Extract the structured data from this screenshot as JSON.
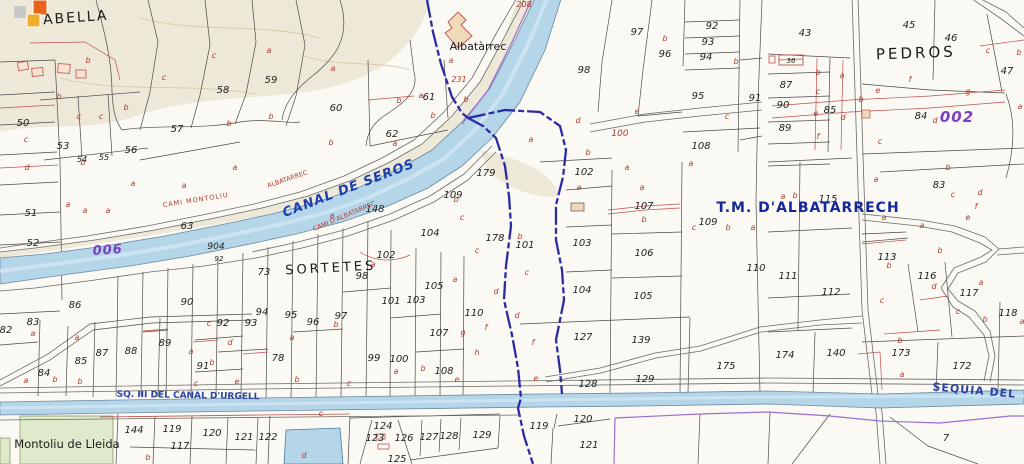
{
  "map": {
    "description": "Cadastral / topographic sheet around Albatarrec, Montoliu de Lleida",
    "colors": {
      "water": "#b5d6e8",
      "water_edge": "#6889a0",
      "municipal_boundary": "#2b2ba6",
      "purple_line": "#9a6fd0",
      "canal_label_blue": "#1b3fae",
      "tm_label_blue": "#16269b",
      "urgell_label_blue": "#2a43a5",
      "cadastral_red": "#b03a2e",
      "purple_code": "#7d3fc1",
      "terrain_tan": "#ebe4d2",
      "green_area": "#dfe9cc"
    },
    "legend_swatches": [
      {
        "name": "grey-swatch",
        "color": "#c8c8c8"
      },
      {
        "name": "orange-swatch",
        "color": "#e8641c"
      },
      {
        "name": "amber-swatch",
        "color": "#efac2d"
      }
    ],
    "place_labels": [
      {
        "text": "ABELLA",
        "x": 76,
        "y": 22,
        "size": 14,
        "color": "#1a1a1a",
        "rot": -4,
        "ls": 2
      },
      {
        "text": "Albatàrrec",
        "x": 478,
        "y": 50,
        "size": 11,
        "color": "#1a1a1a",
        "rot": 0,
        "ls": 0
      },
      {
        "text": "CANAL DE SEROS",
        "x": 350,
        "y": 192,
        "size": 13,
        "color": "#1b3fae",
        "rot": -21,
        "bold": true,
        "italic": true,
        "ls": 1
      },
      {
        "text": "CAMI D'ALBATARREC",
        "x": 345,
        "y": 218,
        "size": 6.5,
        "color": "#b03a2e",
        "rot": -23,
        "ls": 0
      },
      {
        "text": "ALBATARREC",
        "x": 288,
        "y": 181,
        "size": 6.5,
        "color": "#b03a2e",
        "rot": -19,
        "ls": 0
      },
      {
        "text": "CAMI   MONTOLIU",
        "x": 196,
        "y": 202,
        "size": 6.5,
        "color": "#b03a2e",
        "rot": -9,
        "ls": 1
      },
      {
        "text": "SORTETES",
        "x": 331,
        "y": 272,
        "size": 13,
        "color": "#1a1a1a",
        "rot": -3,
        "ls": 3
      },
      {
        "text": "T.M. D'ALBATARRECH",
        "x": 808,
        "y": 212,
        "size": 14,
        "color": "#16269b",
        "rot": 0,
        "bold": true,
        "ls": 1
      },
      {
        "text": "PEDROS",
        "x": 916,
        "y": 58,
        "size": 15,
        "color": "#1a1a1a",
        "rot": -2,
        "ls": 3
      },
      {
        "text": "002",
        "x": 957,
        "y": 122,
        "size": 15,
        "color": "#7d3fc1",
        "rot": 0,
        "bold": true,
        "italic": true,
        "ls": 1
      },
      {
        "text": "006",
        "x": 108,
        "y": 254,
        "size": 13,
        "color": "#7d3fc1",
        "rot": -4,
        "bold": true,
        "italic": true,
        "ls": 1
      },
      {
        "text": "SQ. III DEL CANAL D'URGELL",
        "x": 188,
        "y": 398,
        "size": 9,
        "color": "#2a43a5",
        "rot": 1,
        "bold": true,
        "ls": 0
      },
      {
        "text": "SEQUIA DEL",
        "x": 974,
        "y": 394,
        "size": 11,
        "color": "#2a43a5",
        "rot": 5,
        "bold": true,
        "ls": 1
      },
      {
        "text": "Montoliu de Lleida",
        "x": 67,
        "y": 448,
        "size": 11.5,
        "color": "#1a1a1a",
        "rot": 0,
        "ls": 0
      }
    ],
    "parcel_numbers": [
      {
        "t": "50",
        "x": 23,
        "y": 126
      },
      {
        "t": "53",
        "x": 63,
        "y": 149
      },
      {
        "t": "56",
        "x": 131,
        "y": 153
      },
      {
        "t": "57",
        "x": 177,
        "y": 132
      },
      {
        "t": "58",
        "x": 223,
        "y": 93
      },
      {
        "t": "59",
        "x": 271,
        "y": 83
      },
      {
        "t": "60",
        "x": 336,
        "y": 111
      },
      {
        "t": "61",
        "x": 429,
        "y": 100
      },
      {
        "t": "62",
        "x": 392,
        "y": 137
      },
      {
        "t": "231",
        "x": 459,
        "y": 82,
        "c": "#b03a2e",
        "s": 8
      },
      {
        "t": "208",
        "x": 524,
        "y": 7,
        "c": "#b03a2e",
        "s": 8
      },
      {
        "t": "97",
        "x": 637,
        "y": 35
      },
      {
        "t": "96",
        "x": 665,
        "y": 57
      },
      {
        "t": "98",
        "x": 584,
        "y": 73
      },
      {
        "t": "92",
        "x": 712,
        "y": 29
      },
      {
        "t": "93",
        "x": 708,
        "y": 45
      },
      {
        "t": "94",
        "x": 706,
        "y": 60
      },
      {
        "t": "95",
        "x": 698,
        "y": 99
      },
      {
        "t": "91",
        "x": 755,
        "y": 101
      },
      {
        "t": "100",
        "x": 620,
        "y": 136,
        "c": "#b03a2e",
        "s": 9
      },
      {
        "t": "108",
        "x": 701,
        "y": 149
      },
      {
        "t": "43",
        "x": 805,
        "y": 36
      },
      {
        "t": "45",
        "x": 909,
        "y": 28
      },
      {
        "t": "46",
        "x": 951,
        "y": 41
      },
      {
        "t": "47",
        "x": 1007,
        "y": 74
      },
      {
        "t": "87",
        "x": 786,
        "y": 88
      },
      {
        "t": "90",
        "x": 783,
        "y": 108
      },
      {
        "t": "85",
        "x": 830,
        "y": 113
      },
      {
        "t": "89",
        "x": 785,
        "y": 131
      },
      {
        "t": "84",
        "x": 921,
        "y": 119
      },
      {
        "t": "36",
        "x": 791,
        "y": 63,
        "s": 7
      },
      {
        "t": "51",
        "x": 31,
        "y": 216
      },
      {
        "t": "52",
        "x": 33,
        "y": 246
      },
      {
        "t": "54",
        "x": 82,
        "y": 162,
        "s": 8
      },
      {
        "t": "55",
        "x": 104,
        "y": 160,
        "s": 8
      },
      {
        "t": "63",
        "x": 187,
        "y": 229
      },
      {
        "t": "904",
        "x": 216,
        "y": 249,
        "s": 9
      },
      {
        "t": "92",
        "x": 219,
        "y": 261,
        "s": 7
      },
      {
        "t": "86",
        "x": 75,
        "y": 308
      },
      {
        "t": "90",
        "x": 187,
        "y": 305
      },
      {
        "t": "73",
        "x": 264,
        "y": 275
      },
      {
        "t": "98",
        "x": 362,
        "y": 279
      },
      {
        "t": "102",
        "x": 386,
        "y": 258
      },
      {
        "t": "101",
        "x": 391,
        "y": 304
      },
      {
        "t": "103",
        "x": 416,
        "y": 303
      },
      {
        "t": "105",
        "x": 434,
        "y": 289
      },
      {
        "t": "104",
        "x": 430,
        "y": 236
      },
      {
        "t": "148",
        "x": 375,
        "y": 212
      },
      {
        "t": "179",
        "x": 486,
        "y": 176
      },
      {
        "t": "109",
        "x": 453,
        "y": 198
      },
      {
        "t": "178",
        "x": 495,
        "y": 241
      },
      {
        "t": "102",
        "x": 584,
        "y": 175
      },
      {
        "t": "101",
        "x": 525,
        "y": 248
      },
      {
        "t": "103",
        "x": 582,
        "y": 246
      },
      {
        "t": "104",
        "x": 582,
        "y": 293
      },
      {
        "t": "106",
        "x": 644,
        "y": 256
      },
      {
        "t": "105",
        "x": 643,
        "y": 299
      },
      {
        "t": "107",
        "x": 644,
        "y": 209
      },
      {
        "t": "109",
        "x": 708,
        "y": 225
      },
      {
        "t": "110",
        "x": 756,
        "y": 271
      },
      {
        "t": "115",
        "x": 828,
        "y": 202
      },
      {
        "t": "111",
        "x": 788,
        "y": 279
      },
      {
        "t": "112",
        "x": 831,
        "y": 295
      },
      {
        "t": "113",
        "x": 887,
        "y": 260
      },
      {
        "t": "116",
        "x": 927,
        "y": 279
      },
      {
        "t": "117",
        "x": 969,
        "y": 296
      },
      {
        "t": "83",
        "x": 939,
        "y": 188
      },
      {
        "t": "118",
        "x": 1008,
        "y": 316
      },
      {
        "t": "83",
        "x": 33,
        "y": 325
      },
      {
        "t": "82",
        "x": 6,
        "y": 333
      },
      {
        "t": "84",
        "x": 44,
        "y": 376
      },
      {
        "t": "85",
        "x": 81,
        "y": 364
      },
      {
        "t": "87",
        "x": 102,
        "y": 356
      },
      {
        "t": "88",
        "x": 131,
        "y": 354
      },
      {
        "t": "89",
        "x": 165,
        "y": 346
      },
      {
        "t": "91",
        "x": 203,
        "y": 369
      },
      {
        "t": "92",
        "x": 223,
        "y": 326
      },
      {
        "t": "93",
        "x": 251,
        "y": 326
      },
      {
        "t": "94",
        "x": 262,
        "y": 315
      },
      {
        "t": "95",
        "x": 291,
        "y": 318
      },
      {
        "t": "96",
        "x": 313,
        "y": 325
      },
      {
        "t": "97",
        "x": 341,
        "y": 319
      },
      {
        "t": "78",
        "x": 278,
        "y": 361
      },
      {
        "t": "99",
        "x": 374,
        "y": 361
      },
      {
        "t": "100",
        "x": 399,
        "y": 362
      },
      {
        "t": "107",
        "x": 439,
        "y": 336
      },
      {
        "t": "108",
        "x": 444,
        "y": 374
      },
      {
        "t": "110",
        "x": 474,
        "y": 316
      },
      {
        "t": "122",
        "x": 268,
        "y": 440
      },
      {
        "t": "123",
        "x": 375,
        "y": 441
      },
      {
        "t": "124",
        "x": 383,
        "y": 429
      },
      {
        "t": "126",
        "x": 404,
        "y": 441
      },
      {
        "t": "127",
        "x": 429,
        "y": 440
      },
      {
        "t": "128",
        "x": 449,
        "y": 439
      },
      {
        "t": "129",
        "x": 482,
        "y": 438
      },
      {
        "t": "125",
        "x": 397,
        "y": 462
      },
      {
        "t": "144",
        "x": 134,
        "y": 433
      },
      {
        "t": "119",
        "x": 172,
        "y": 432
      },
      {
        "t": "120",
        "x": 212,
        "y": 436
      },
      {
        "t": "121",
        "x": 244,
        "y": 440
      },
      {
        "t": "117",
        "x": 180,
        "y": 449
      },
      {
        "t": "127",
        "x": 583,
        "y": 340
      },
      {
        "t": "139",
        "x": 641,
        "y": 343
      },
      {
        "t": "128",
        "x": 588,
        "y": 387
      },
      {
        "t": "129",
        "x": 645,
        "y": 382
      },
      {
        "t": "175",
        "x": 726,
        "y": 369
      },
      {
        "t": "119",
        "x": 539,
        "y": 429
      },
      {
        "t": "120",
        "x": 583,
        "y": 422
      },
      {
        "t": "121",
        "x": 589,
        "y": 448
      },
      {
        "t": "174",
        "x": 785,
        "y": 358
      },
      {
        "t": "140",
        "x": 836,
        "y": 356
      },
      {
        "t": "173",
        "x": 901,
        "y": 356
      },
      {
        "t": "172",
        "x": 962,
        "y": 369
      },
      {
        "t": "7",
        "x": 946,
        "y": 441
      }
    ],
    "subparcel_letters": [
      {
        "t": "b",
        "x": 88,
        "y": 63
      },
      {
        "t": "c",
        "x": 214,
        "y": 58
      },
      {
        "t": "b",
        "x": 59,
        "y": 99
      },
      {
        "t": "c",
        "x": 79,
        "y": 119
      },
      {
        "t": "c",
        "x": 101,
        "y": 119
      },
      {
        "t": "b",
        "x": 126,
        "y": 110
      },
      {
        "t": "c",
        "x": 164,
        "y": 80
      },
      {
        "t": "b",
        "x": 229,
        "y": 126
      },
      {
        "t": "c",
        "x": 26,
        "y": 142
      },
      {
        "t": "a",
        "x": 269,
        "y": 53
      },
      {
        "t": "a",
        "x": 333,
        "y": 71
      },
      {
        "t": "b",
        "x": 271,
        "y": 119
      },
      {
        "t": "b",
        "x": 331,
        "y": 145
      },
      {
        "t": "a",
        "x": 421,
        "y": 98
      },
      {
        "t": "b",
        "x": 399,
        "y": 103
      },
      {
        "t": "b",
        "x": 466,
        "y": 102
      },
      {
        "t": "b",
        "x": 433,
        "y": 118
      },
      {
        "t": "a",
        "x": 395,
        "y": 146
      },
      {
        "t": "a",
        "x": 451,
        "y": 63
      },
      {
        "t": "b",
        "x": 665,
        "y": 41
      },
      {
        "t": "e",
        "x": 637,
        "y": 114
      },
      {
        "t": "d",
        "x": 578,
        "y": 123
      },
      {
        "t": "c",
        "x": 727,
        "y": 119
      },
      {
        "t": "a",
        "x": 531,
        "y": 142
      },
      {
        "t": "b",
        "x": 588,
        "y": 155
      },
      {
        "t": "b",
        "x": 736,
        "y": 64
      },
      {
        "t": "b",
        "x": 818,
        "y": 75
      },
      {
        "t": "a",
        "x": 842,
        "y": 78
      },
      {
        "t": "c",
        "x": 818,
        "y": 94
      },
      {
        "t": "e",
        "x": 816,
        "y": 116
      },
      {
        "t": "d",
        "x": 843,
        "y": 120
      },
      {
        "t": "f",
        "x": 818,
        "y": 139
      },
      {
        "t": "b",
        "x": 861,
        "y": 102
      },
      {
        "t": "f",
        "x": 910,
        "y": 82
      },
      {
        "t": "e",
        "x": 878,
        "y": 93
      },
      {
        "t": "g",
        "x": 968,
        "y": 94
      },
      {
        "t": "c",
        "x": 880,
        "y": 144
      },
      {
        "t": "d",
        "x": 935,
        "y": 123
      },
      {
        "t": "a",
        "x": 1020,
        "y": 109
      },
      {
        "t": "c",
        "x": 988,
        "y": 53
      },
      {
        "t": "b",
        "x": 1019,
        "y": 55
      },
      {
        "t": "d",
        "x": 27,
        "y": 170
      },
      {
        "t": "a",
        "x": 68,
        "y": 207
      },
      {
        "t": "a",
        "x": 85,
        "y": 213
      },
      {
        "t": "a",
        "x": 108,
        "y": 213
      },
      {
        "t": "a",
        "x": 133,
        "y": 186
      },
      {
        "t": "a",
        "x": 184,
        "y": 188
      },
      {
        "t": "b",
        "x": 83,
        "y": 165
      },
      {
        "t": "a",
        "x": 235,
        "y": 170
      },
      {
        "t": "a",
        "x": 332,
        "y": 218
      },
      {
        "t": "a",
        "x": 373,
        "y": 267
      },
      {
        "t": "b",
        "x": 456,
        "y": 202
      },
      {
        "t": "c",
        "x": 462,
        "y": 220
      },
      {
        "t": "c",
        "x": 477,
        "y": 253
      },
      {
        "t": "d",
        "x": 496,
        "y": 294
      },
      {
        "t": "a",
        "x": 455,
        "y": 282
      },
      {
        "t": "a",
        "x": 579,
        "y": 190
      },
      {
        "t": "a",
        "x": 642,
        "y": 190
      },
      {
        "t": "a",
        "x": 627,
        "y": 170
      },
      {
        "t": "b",
        "x": 644,
        "y": 222
      },
      {
        "t": "c",
        "x": 694,
        "y": 230
      },
      {
        "t": "b",
        "x": 728,
        "y": 230
      },
      {
        "t": "a",
        "x": 753,
        "y": 230
      },
      {
        "t": "a",
        "x": 691,
        "y": 166
      },
      {
        "t": "b",
        "x": 520,
        "y": 239
      },
      {
        "t": "c",
        "x": 527,
        "y": 275
      },
      {
        "t": "a",
        "x": 876,
        "y": 182
      },
      {
        "t": "b",
        "x": 948,
        "y": 170
      },
      {
        "t": "c",
        "x": 953,
        "y": 197
      },
      {
        "t": "d",
        "x": 980,
        "y": 195
      },
      {
        "t": "e",
        "x": 968,
        "y": 220
      },
      {
        "t": "f",
        "x": 976,
        "y": 209
      },
      {
        "t": "a",
        "x": 884,
        "y": 220
      },
      {
        "t": "a",
        "x": 922,
        "y": 228
      },
      {
        "t": "b",
        "x": 940,
        "y": 253
      },
      {
        "t": "d",
        "x": 934,
        "y": 289
      },
      {
        "t": "a",
        "x": 981,
        "y": 285
      },
      {
        "t": "c",
        "x": 882,
        "y": 303
      },
      {
        "t": "b",
        "x": 889,
        "y": 268
      },
      {
        "t": "a",
        "x": 783,
        "y": 199
      },
      {
        "t": "b",
        "x": 795,
        "y": 198
      },
      {
        "t": "a",
        "x": 33,
        "y": 336
      },
      {
        "t": "a",
        "x": 77,
        "y": 340
      },
      {
        "t": "b",
        "x": 55,
        "y": 382
      },
      {
        "t": "a",
        "x": 26,
        "y": 383
      },
      {
        "t": "b",
        "x": 80,
        "y": 384
      },
      {
        "t": "c",
        "x": 209,
        "y": 326
      },
      {
        "t": "a",
        "x": 191,
        "y": 354
      },
      {
        "t": "d",
        "x": 230,
        "y": 345
      },
      {
        "t": "b",
        "x": 212,
        "y": 365
      },
      {
        "t": "c",
        "x": 196,
        "y": 386
      },
      {
        "t": "e",
        "x": 237,
        "y": 384
      },
      {
        "t": "b",
        "x": 148,
        "y": 460
      },
      {
        "t": "a",
        "x": 292,
        "y": 340
      },
      {
        "t": "b",
        "x": 297,
        "y": 382
      },
      {
        "t": "b",
        "x": 336,
        "y": 327
      },
      {
        "t": "c",
        "x": 321,
        "y": 416
      },
      {
        "t": "d",
        "x": 304,
        "y": 458
      },
      {
        "t": "a",
        "x": 396,
        "y": 374
      },
      {
        "t": "b",
        "x": 423,
        "y": 371
      },
      {
        "t": "g",
        "x": 463,
        "y": 335
      },
      {
        "t": "f",
        "x": 486,
        "y": 330
      },
      {
        "t": "h",
        "x": 477,
        "y": 355
      },
      {
        "t": "e",
        "x": 457,
        "y": 382
      },
      {
        "t": "c",
        "x": 349,
        "y": 386
      },
      {
        "t": "f",
        "x": 533,
        "y": 345
      },
      {
        "t": "e",
        "x": 536,
        "y": 381
      },
      {
        "t": "d",
        "x": 517,
        "y": 318
      },
      {
        "t": "b",
        "x": 900,
        "y": 343
      },
      {
        "t": "a",
        "x": 902,
        "y": 377
      },
      {
        "t": "b",
        "x": 985,
        "y": 322
      },
      {
        "t": "c",
        "x": 958,
        "y": 314
      },
      {
        "t": "a",
        "x": 1022,
        "y": 324
      }
    ]
  }
}
